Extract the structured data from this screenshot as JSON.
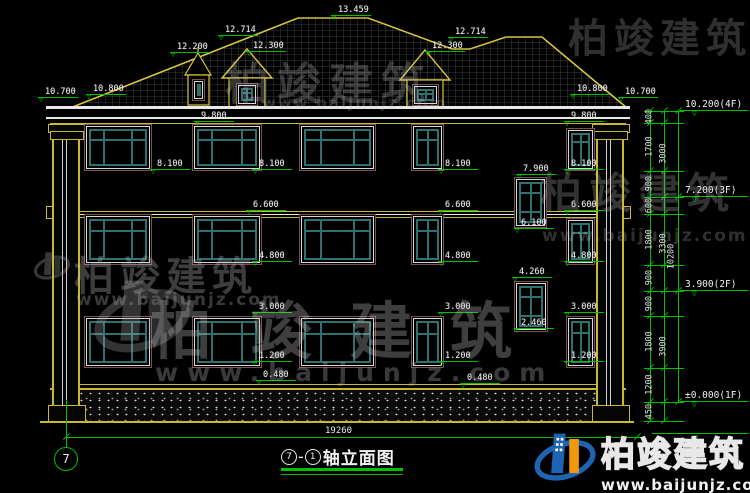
{
  "watermark": {
    "name": "柏竣建筑",
    "url": "www.baijunjz.com"
  },
  "title": {
    "axis_from": "7",
    "axis_to": "1",
    "dash": "-",
    "label": "轴立面图"
  },
  "axis_bubble": "7",
  "dims": {
    "overall_width": "19260",
    "total_height": "10200",
    "chain_inner": [
      {
        "v": "400",
        "y1": 111,
        "y2": 123
      },
      {
        "v": "1700",
        "y1": 123,
        "y2": 171
      },
      {
        "v": "900",
        "y1": 171,
        "y2": 197
      },
      {
        "v": "600",
        "y1": 197,
        "y2": 214
      },
      {
        "v": "1800",
        "y1": 214,
        "y2": 265
      },
      {
        "v": "900",
        "y1": 265,
        "y2": 291
      },
      {
        "v": "900",
        "y1": 291,
        "y2": 316
      },
      {
        "v": "1800",
        "y1": 316,
        "y2": 368
      },
      {
        "v": "1200",
        "y1": 368,
        "y2": 402
      },
      {
        "v": "450",
        "y1": 402,
        "y2": 421
      }
    ],
    "chain_mid": [
      {
        "v": "3000",
        "y1": 111,
        "y2": 197
      },
      {
        "v": "3300",
        "y1": 197,
        "y2": 291
      },
      {
        "v": "3900",
        "y1": 291,
        "y2": 402
      }
    ]
  },
  "callouts": [
    {
      "text": "10.200(4F)",
      "y": 111
    },
    {
      "text": "7.200(3F)",
      "y": 197
    },
    {
      "text": "3.900(2F)",
      "y": 291
    },
    {
      "text": "±0.000(1F)",
      "y": 402
    }
  ],
  "elevation_marks": [
    {
      "t": "10.700",
      "x": 38,
      "y": 88
    },
    {
      "t": "10.800",
      "x": 86,
      "y": 85
    },
    {
      "t": "12.200",
      "x": 170,
      "y": 43
    },
    {
      "t": "12.714",
      "x": 218,
      "y": 26
    },
    {
      "t": "12.300",
      "x": 246,
      "y": 42
    },
    {
      "t": "13.459",
      "x": 331,
      "y": 6
    },
    {
      "t": "12.300",
      "x": 425,
      "y": 42
    },
    {
      "t": "12.714",
      "x": 448,
      "y": 28
    },
    {
      "t": "10.800",
      "x": 570,
      "y": 85
    },
    {
      "t": "10.700",
      "x": 618,
      "y": 88
    },
    {
      "t": "9.800",
      "x": 194,
      "y": 112
    },
    {
      "t": "9.800",
      "x": 564,
      "y": 112
    },
    {
      "t": "8.100",
      "x": 150,
      "y": 160
    },
    {
      "t": "8.100",
      "x": 252,
      "y": 160
    },
    {
      "t": "8.100",
      "x": 438,
      "y": 160
    },
    {
      "t": "8.100",
      "x": 564,
      "y": 160
    },
    {
      "t": "7.900",
      "x": 516,
      "y": 165
    },
    {
      "t": "6.600",
      "x": 246,
      "y": 201
    },
    {
      "t": "6.600",
      "x": 438,
      "y": 201
    },
    {
      "t": "6.600",
      "x": 564,
      "y": 201
    },
    {
      "t": "6.100",
      "x": 514,
      "y": 219
    },
    {
      "t": "4.800",
      "x": 252,
      "y": 252
    },
    {
      "t": "4.800",
      "x": 438,
      "y": 252
    },
    {
      "t": "4.800",
      "x": 564,
      "y": 252
    },
    {
      "t": "4.260",
      "x": 512,
      "y": 268
    },
    {
      "t": "3.000",
      "x": 252,
      "y": 303
    },
    {
      "t": "3.000",
      "x": 438,
      "y": 303
    },
    {
      "t": "3.000",
      "x": 564,
      "y": 303
    },
    {
      "t": "2.460",
      "x": 514,
      "y": 319
    },
    {
      "t": "1.200",
      "x": 252,
      "y": 352
    },
    {
      "t": "1.200",
      "x": 438,
      "y": 352
    },
    {
      "t": "1.200",
      "x": 564,
      "y": 352
    },
    {
      "t": "0.480",
      "x": 256,
      "y": 371
    },
    {
      "t": "0.480",
      "x": 460,
      "y": 374
    }
  ]
}
